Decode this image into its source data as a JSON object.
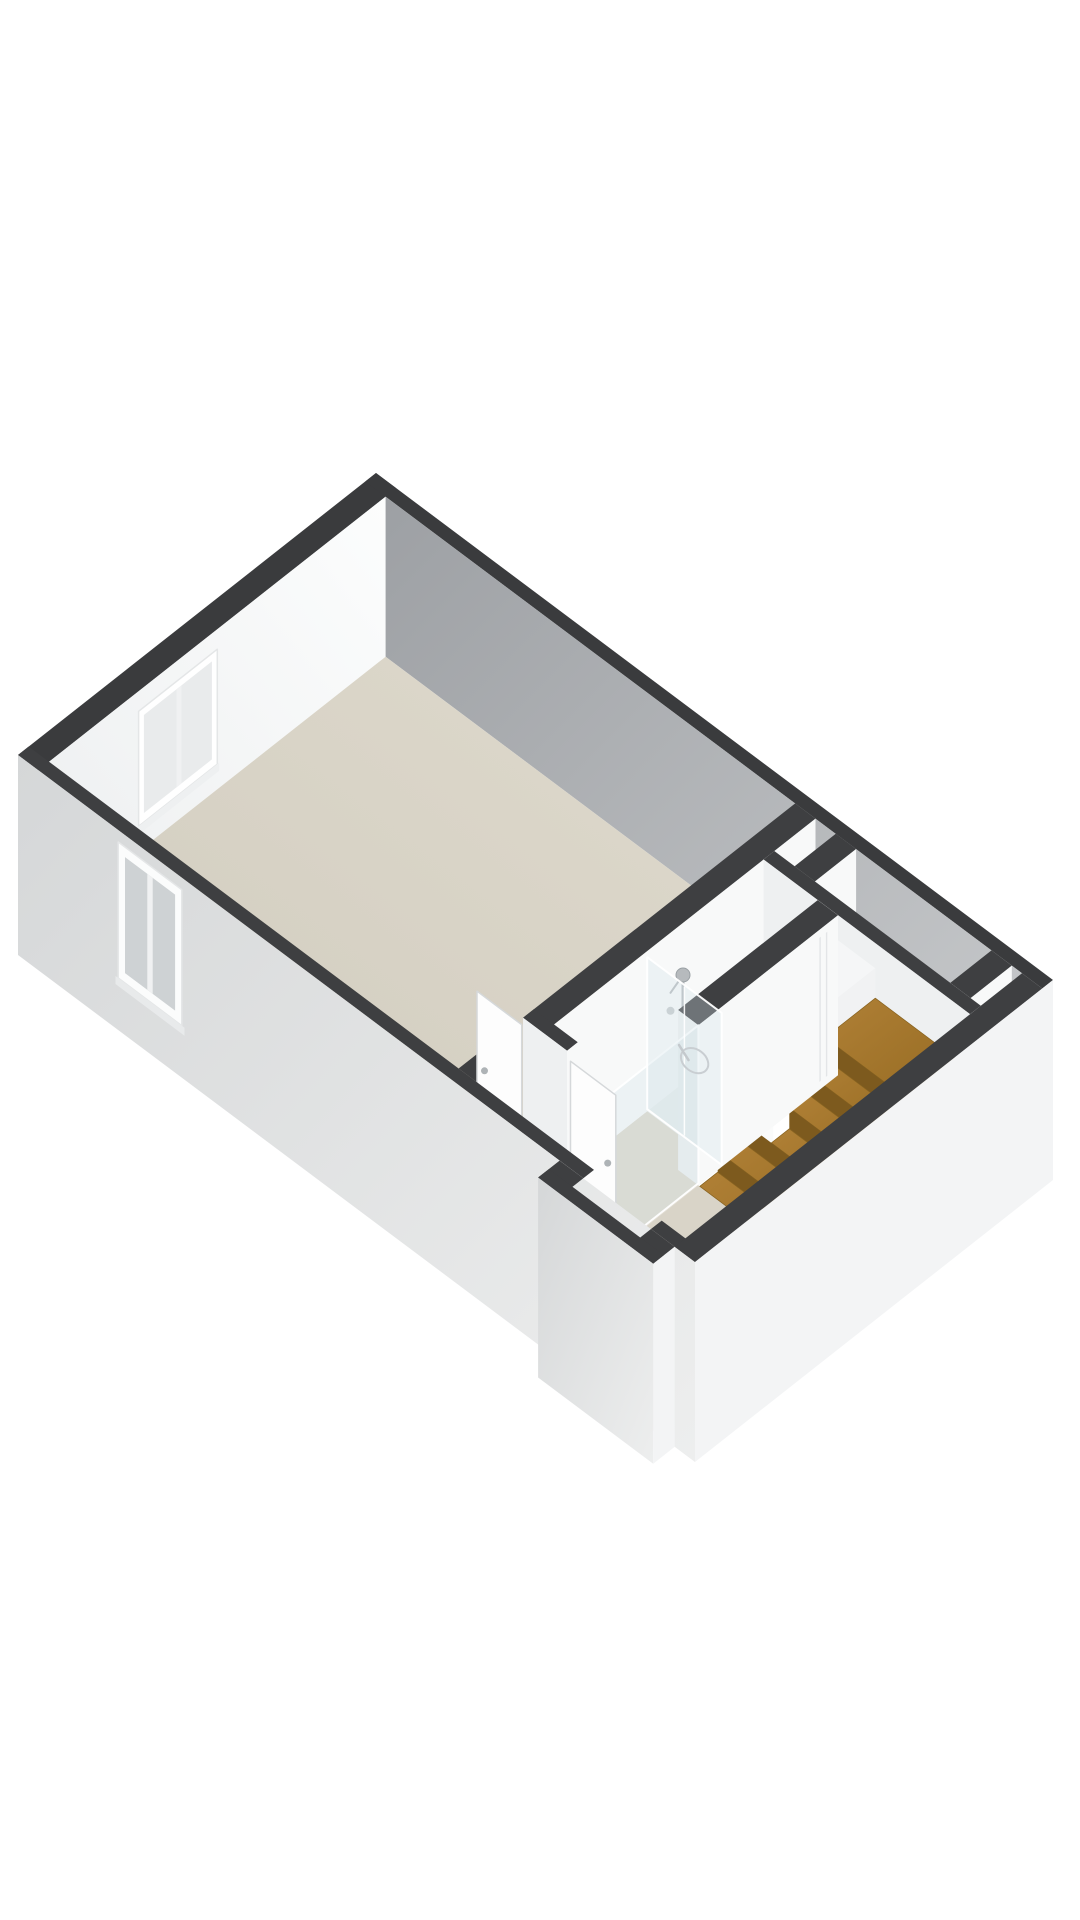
{
  "page": {
    "background": "#ffffff"
  },
  "floorplan": {
    "type": "3d-axonometric-floor-plan",
    "view": "isometric-top-down",
    "rooms": [
      "main-room",
      "bathroom",
      "hallway",
      "staircase",
      "storage-niche",
      "entry"
    ],
    "features": [
      "inner-window",
      "exterior-window",
      "shower-glass-screen",
      "glass-balustrade",
      "shower-drain",
      "shower-fixture",
      "door-leaf",
      "wooden-staircase",
      "entry-steps",
      "floor-hatch-outline"
    ]
  },
  "colors": {
    "wallTop": "#3e3f41",
    "wallTopFar": "#3a3b3d",
    "faceU": "#f8f9f9",
    "faceV": "#eef0f1",
    "floorShaft": "#e3e4e4",
    "floorNiche": "#d9dadc",
    "floorBath": "#eef0ee",
    "floorBathLo": "#dcd7cb",
    "floorHall": "#d9d4c8",
    "extRight": "#f3f4f5",
    "glassFill": "rgba(213,226,233,0.32)",
    "glassEdge": "rgba(255,255,255,0.95)",
    "glassPane": "#ced2d4",
    "white": "#fdfdfd",
    "frame": "#e4e6e7",
    "sill": "#eef0f1",
    "mullion": "#f0f1f2",
    "metal": "#b6babd",
    "drain": "#a7adb0",
    "drainInner": "#8a9094",
    "woodDark": "#7d5a1e",
    "woodEdge": "#87621f",
    "stepWhite": "#f5f6f7",
    "stepRiser": "#e2e4e6",
    "leafStroke": "#d5d8da",
    "handle": "#aeb3b6",
    "hatchLine": "#fcfdfd",
    "gradO1a": "#fcfdfd",
    "gradO1b": "#edeff0",
    "gradO2a": "#9da0a4",
    "gradO2b": "#c8cacc",
    "gradFloorA": "#dfdacd",
    "gradFloorB": "#d0cbbe",
    "gradExtA": "#d5d7d8",
    "gradExtB": "#edeeee",
    "gradWoodA": "#b08036",
    "gradWoodB": "#936920"
  }
}
